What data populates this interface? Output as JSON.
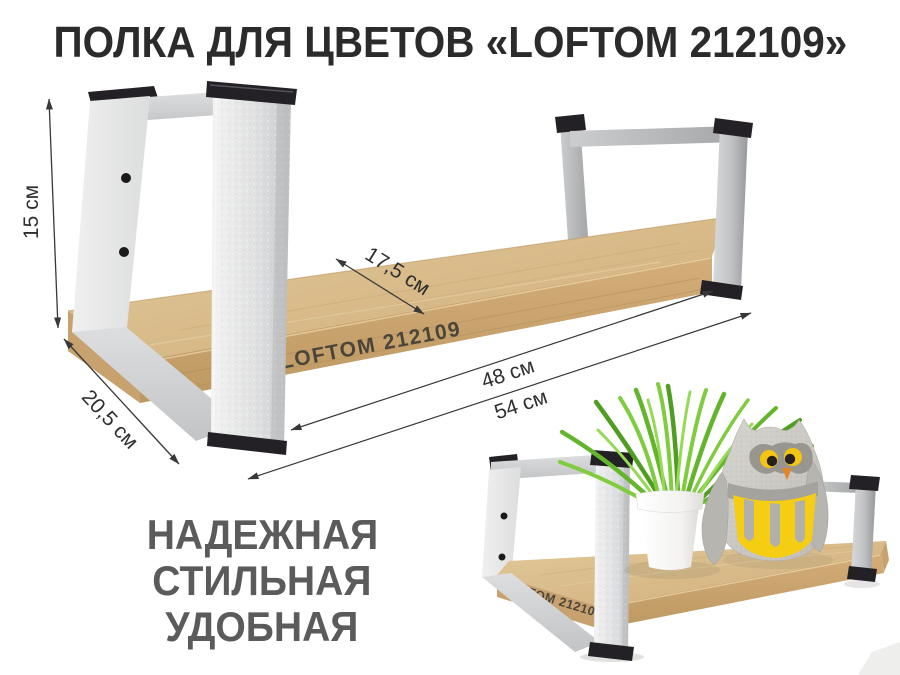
{
  "title": "ПОЛКА ДЛЯ ЦВЕТОВ «LOFTOM 212109»",
  "dimensions": {
    "height": "15 см",
    "depth": "20,5 см",
    "shelf_depth": "17,5 см",
    "mount_width": "48 см",
    "total_width": "54 см"
  },
  "branding": {
    "board_label": "LOFTOM 212109"
  },
  "features": {
    "lines": [
      "НАДЕЖНАЯ",
      "СТИЛЬНАЯ",
      "УДОБНАЯ"
    ]
  },
  "colors": {
    "wood_top": "#d9bd8e",
    "wood_edge": "#c9a470",
    "metal_white": "#e4e5e6",
    "metal_gray": "#b7b9bb",
    "cap_dark": "#232026",
    "title_text": "#2b2b2b",
    "feature_text": "#5b5b5b",
    "dimension_lines": "#383838",
    "grass_green": "#63b52b",
    "owl_yellow": "#f5ce14",
    "owl_gray": "#ccc9c3",
    "pot_white": "#fbfbfa"
  }
}
